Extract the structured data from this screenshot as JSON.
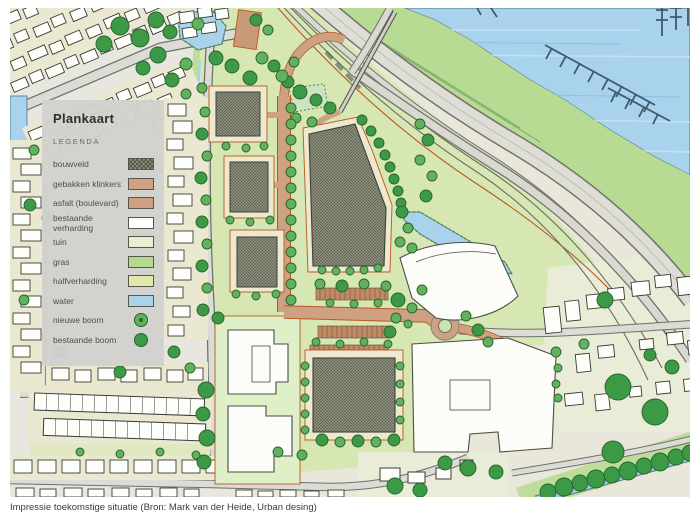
{
  "page": {
    "caption": "Impressie toekomstige situatie (Bron: Mark van der Heide, Urban desing)"
  },
  "legend": {
    "title": "Plankaart",
    "subtitle": "LEGENDA",
    "items": [
      {
        "label": "bouwveld",
        "type": "hatch",
        "color": "#8e907e"
      },
      {
        "label": "gebakken klinkers",
        "type": "swatch",
        "color": "#cfa183"
      },
      {
        "label": "asfalt (boulevard)",
        "type": "swatch",
        "color": "#cfa183"
      },
      {
        "label": "bestaande verharding",
        "type": "swatch",
        "color": "#ffffff"
      },
      {
        "label": "tuin",
        "type": "swatch",
        "color": "#e9efce"
      },
      {
        "label": "gras",
        "type": "swatch",
        "color": "#b5d98e"
      },
      {
        "label": "halfverharding",
        "type": "swatch",
        "color": "#e2e8a9"
      },
      {
        "label": "water",
        "type": "swatch",
        "color": "#a9d3ec"
      },
      {
        "label": "nieuwe boom",
        "type": "tree-new",
        "color": "#63b05e"
      },
      {
        "label": "bestaande boom",
        "type": "tree-old",
        "color": "#3c9a46"
      }
    ]
  },
  "map": {
    "colors": {
      "base": "#e9e7d9",
      "development_green": "#d6e7b4",
      "bank_green": "#b7db92",
      "water": "#a9d3ec",
      "road": "#dcdcd6",
      "brick": "#cfa183",
      "building_hatch": "#8e907e",
      "existing_building": "#fcfcf9",
      "tree_new": "#63b05e",
      "tree_existing": "#3c9a46",
      "plan_boundary_red": "#b9571f"
    }
  }
}
